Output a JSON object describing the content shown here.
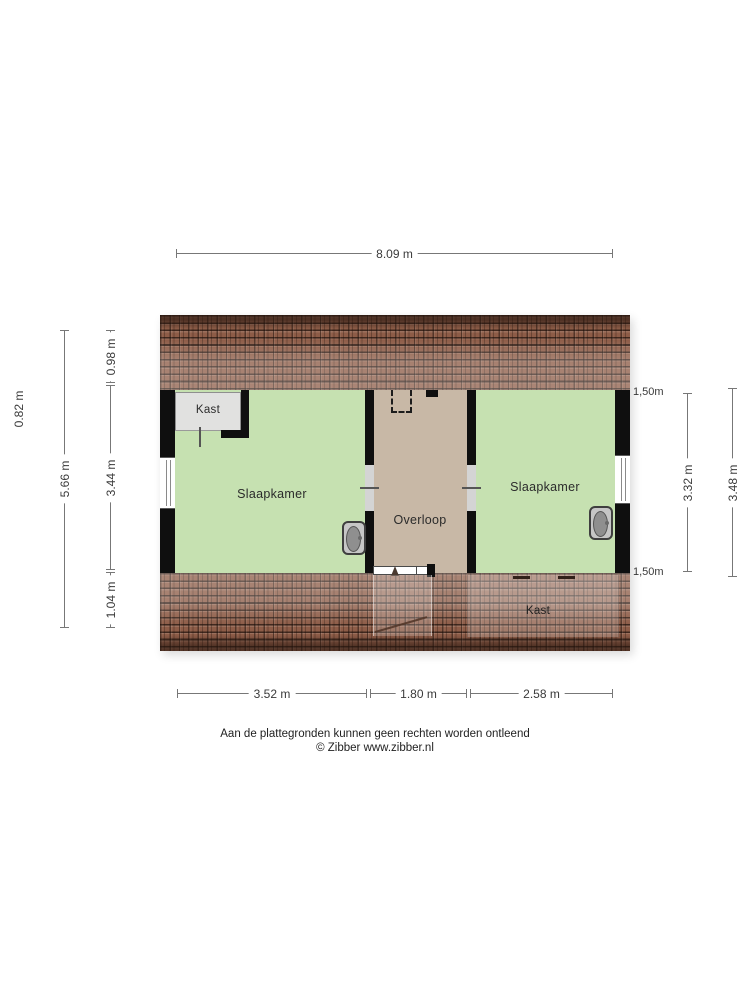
{
  "plan_title": "attic floor plan",
  "rooms": {
    "left_bedroom": "Slaapkamer",
    "right_bedroom": "Slaapkamer",
    "landing": "Overloop",
    "closet_top_left": "Kast",
    "closet_bottom_right": "Kast"
  },
  "dimensions": {
    "top_width": "8.09 m",
    "left_outer": "0.82 m",
    "left_total": "5.66 m",
    "left_segments": [
      "0.98 m",
      "3.44 m",
      "1.04 m"
    ],
    "right_ceiling_top": "1,50m",
    "right_ceiling_bottom": "1,50m",
    "right_inner": "3.32 m",
    "right_outer": "3.48 m",
    "bottom_segments": [
      "3.52 m",
      "1.80 m",
      "2.58 m"
    ]
  },
  "footer": {
    "disclaimer": "Aan de plattegronden kunnen geen rechten worden ontleend",
    "copyright": "© Zibber www.zibber.nl"
  },
  "colors": {
    "room_green": "#c6e1b1",
    "landing_tan": "#c8b8a6",
    "closet_gray": "#e1e1e0",
    "wall_black": "#0f0f0f",
    "roof_brown": "#8d5c47",
    "opening_gray": "#d4d4d4",
    "dim_line": "#777777",
    "dim_text": "#3a3a3a"
  }
}
